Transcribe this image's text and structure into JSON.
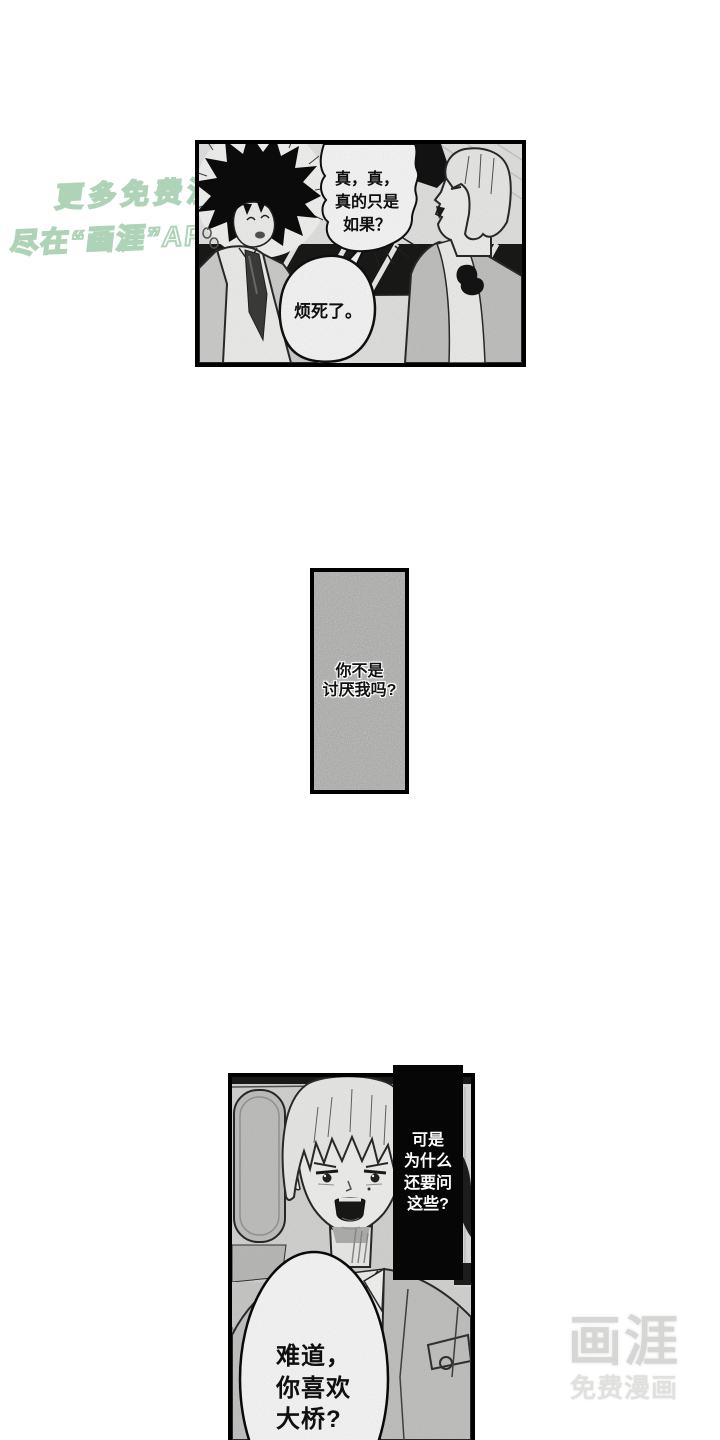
{
  "page_type": "manga-reader-page",
  "watermark": {
    "line1": "更多免费漫画",
    "line2": "尽在“画涯”APP"
  },
  "panel1": {
    "bubble1": {
      "line1": "真，真，",
      "line2": "真的只是",
      "line3": "如果？"
    },
    "bubble2": {
      "line1": "烦死了。"
    }
  },
  "panel2": {
    "caption": {
      "line1": "你不是",
      "line2": "讨厌我吗?"
    }
  },
  "panel3": {
    "narration": {
      "line1": "可是",
      "line2": "为什么",
      "line3": "还要问",
      "line4": "这些?"
    },
    "bubble": {
      "line1": "难道，",
      "line2": "你喜欢",
      "line3": "大桥?"
    }
  },
  "logo": {
    "name": "画涯",
    "tagline": "免费漫画"
  },
  "colors": {
    "page_background": "#ffffff",
    "watermark_fill": "#ffffff",
    "watermark_outline": "#96c7a2",
    "panel_border": "#000000",
    "panel2_fill": "#d8d8d6",
    "narration_box_bg": "#060606",
    "narration_text": "#ffffff",
    "logo_gray": "#d6d6d4"
  }
}
